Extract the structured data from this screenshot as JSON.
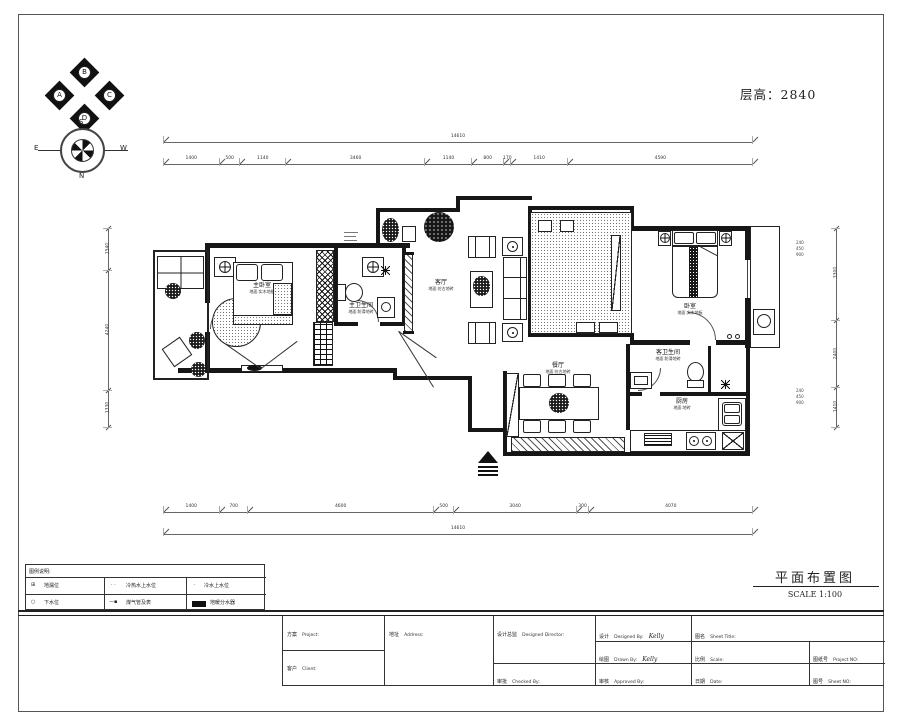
{
  "header": {
    "floor_height": "层高：2840",
    "compass": {
      "n": "N",
      "s": "S",
      "e": "E",
      "w": "W"
    },
    "elevation": {
      "top": "B",
      "left": "A",
      "right": "C",
      "bottom": "D"
    }
  },
  "rooms": {
    "master_bedroom": {
      "name": "主卧室",
      "finish": "地面:实木地板"
    },
    "master_bath": {
      "name": "主卫生间",
      "finish": "地面:防滑地砖"
    },
    "living": {
      "name": "客厅",
      "finish": "地面:仿古地砖"
    },
    "bedroom": {
      "name": "卧室",
      "finish": "地面:实木地板"
    },
    "guest_bath": {
      "name": "客卫生间",
      "finish": "地面:防滑地砖"
    },
    "kitchen": {
      "name": "厨房",
      "finish": "地面:地砖"
    },
    "dining": {
      "name": "餐厅",
      "finish": "地面:仿古地砖"
    }
  },
  "annotations": {
    "r1": [
      "240",
      "450",
      "900"
    ],
    "r2": [
      "240",
      "450",
      "900"
    ]
  },
  "dimensions": {
    "top_total": [
      "14610"
    ],
    "top_segments": [
      "1400",
      "500",
      "1140",
      "3460",
      "1140",
      "800",
      "170",
      "1410",
      "4590"
    ],
    "bottom_segments": [
      "1400",
      "700",
      "4600",
      "500",
      "3040",
      "300",
      "4070"
    ],
    "bottom_total": [
      "14610"
    ],
    "left_segments": [
      "1540",
      "4240",
      "1330"
    ],
    "right_segments": [
      "3300",
      "2400",
      "1410"
    ]
  },
  "legend": {
    "title": "图例说明:",
    "rows": [
      [
        {
          "icon": "⊞",
          "label": "地漏位"
        },
        {
          "icon": "· ·",
          "label": "冷热水上水位"
        },
        {
          "icon": "·",
          "label": "冷水上水位"
        }
      ],
      [
        {
          "icon": "○",
          "label": "下水位"
        },
        {
          "icon": "—▪",
          "label": "煤气管及表"
        },
        {
          "icon": "",
          "label": "地暖分水器"
        }
      ]
    ]
  },
  "sheet": {
    "drawing_title": "平面布置图",
    "scale_label": "SCALE 1:100"
  },
  "titleblock": {
    "project": {
      "zh": "方案",
      "en": "Project:"
    },
    "client": {
      "zh": "客户",
      "en": "Client:"
    },
    "address": {
      "zh": "地址",
      "en": "Address:"
    },
    "director": {
      "zh": "设计总监",
      "en": "Designed Director:"
    },
    "checked": {
      "zh": "审批",
      "en": "Checked By:"
    },
    "designed": {
      "zh": "设计",
      "en": "Designed By:",
      "value": "Kelly"
    },
    "drawn": {
      "zh": "绘图",
      "en": "Drawn By:",
      "value": "Kelly"
    },
    "approved": {
      "zh": "审核",
      "en": "Approved By:"
    },
    "sheet_title": {
      "zh": "图名",
      "en": "Sheet Title:"
    },
    "scale": {
      "zh": "比例",
      "en": "Scale:"
    },
    "date": {
      "zh": "日期",
      "en": "Date:"
    },
    "project_no": {
      "zh": "图纸号",
      "en": "Project NO:"
    },
    "sheet_no": {
      "zh": "图号",
      "en": "Sheet NO:"
    }
  }
}
